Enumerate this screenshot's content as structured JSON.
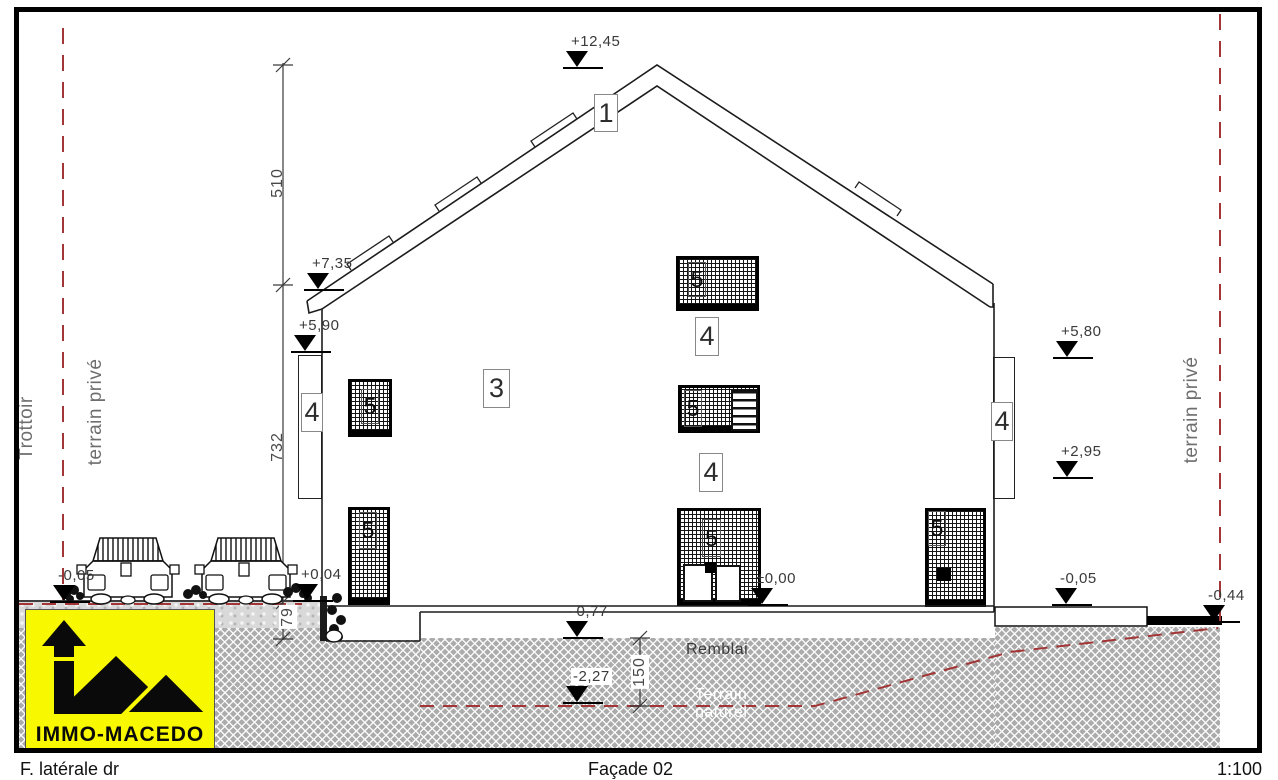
{
  "titlebar": {
    "view": "F. latérale dr",
    "sheet": "Façade 02",
    "scale": "1:100"
  },
  "site": {
    "sidewalk_label": "Trottoir",
    "private_left": "terrain privé",
    "private_right": "terrain privé"
  },
  "markers": {
    "ridge": "+12,45",
    "eave_left": "+7,35",
    "left_upper": "+5,90",
    "entry": "+0,04",
    "street_left": "-0,05",
    "door_zero": "±0,00",
    "excavation": "-0,77",
    "natural": "-2,27",
    "right_upper": "+5,80",
    "right_mid": "+2,95",
    "sidewalk_right": "-0,05",
    "terrain_right": "-0,44"
  },
  "dimensions": {
    "roof": "510",
    "facade": "732",
    "plinth": "79",
    "fill_depth": "150"
  },
  "tags": {
    "roof": "1",
    "facade": "3",
    "railing": "4",
    "opening": "5"
  },
  "ground": {
    "fill_label": "Remblai",
    "natural_line1": "Terrain",
    "natural_line2": "naturel"
  },
  "logo": {
    "name": "IMMO-MACEDO"
  },
  "colors": {
    "accent_yellow": "#f8f800",
    "terrain_line_red": "#a23535",
    "hatch_gray": "#ababab"
  }
}
